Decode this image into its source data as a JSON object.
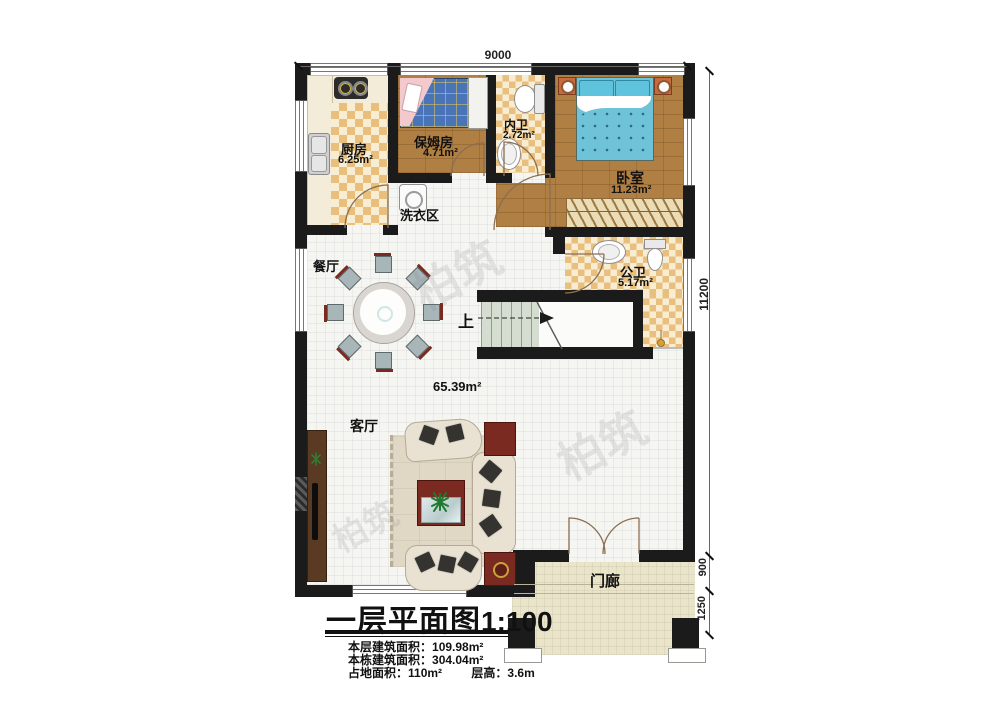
{
  "title": {
    "main": "一层平面图",
    "scale": "1:100"
  },
  "stats": {
    "s1": {
      "label": "本层建筑面积：",
      "value": "109.98m²"
    },
    "s2": {
      "label": "本栋建筑面积：",
      "value": "304.04m²"
    },
    "s3": {
      "label": "占地面积：",
      "value": "110m²"
    },
    "s4": {
      "label": "层高：",
      "value": "3.6m"
    }
  },
  "dims": {
    "top": "9000",
    "right": "11200",
    "porch_a": "900",
    "porch_b": "1250"
  },
  "rooms": {
    "kitchen": {
      "name": "厨房",
      "area": "6.25m²"
    },
    "nanny": {
      "name": "保姆房",
      "area": "4.71m²"
    },
    "inner_bath": {
      "name": "内卫",
      "area": "2.72m²"
    },
    "bedroom": {
      "name": "卧室",
      "area": "11.23m²"
    },
    "laundry": {
      "name": "洗衣区"
    },
    "dining": {
      "name": "餐厅"
    },
    "public_bath": {
      "name": "公卫",
      "area": "5.17m²"
    },
    "living": {
      "name": "客厅",
      "area": "65.39m²"
    },
    "porch": {
      "name": "门廊"
    }
  },
  "stairs": {
    "up": "上"
  },
  "watermark": {
    "text": "柏筑"
  },
  "colors": {
    "wall": "#1b1b1b",
    "wood": "#b07f44",
    "checker": "#e8bf7c",
    "bed_blue": "#6fc3d9",
    "accent_red": "#7a2a20",
    "porch": "#eae5c9"
  }
}
